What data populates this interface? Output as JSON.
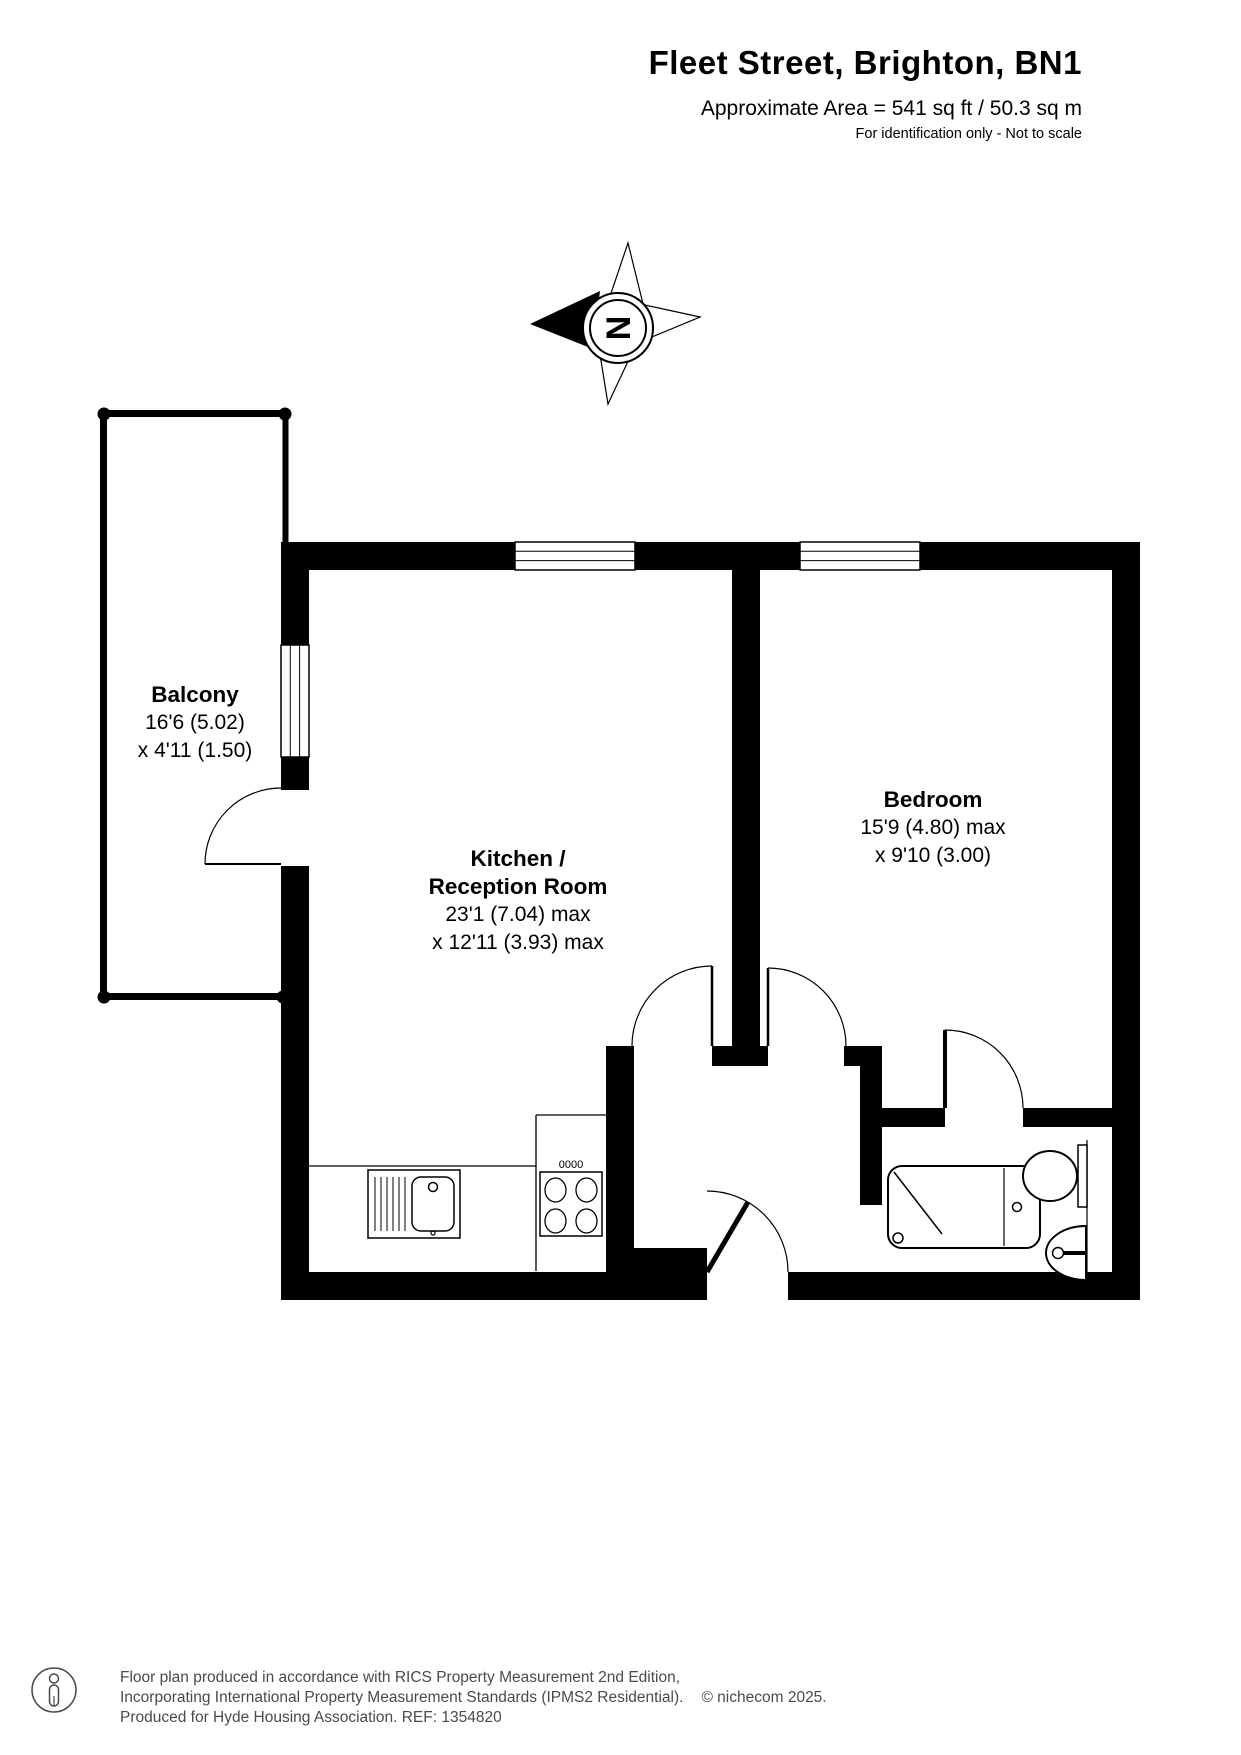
{
  "header": {
    "title": "Fleet Street, Brighton, BN1",
    "area": "Approximate Area = 541 sq ft / 50.3 sq m",
    "disclaimer": "For identification only - Not to scale"
  },
  "compass": {
    "label": "N"
  },
  "rooms": {
    "balcony": {
      "name": "Balcony",
      "dim1": "16'6 (5.02)",
      "dim2": "x 4'11 (1.50)"
    },
    "kitchen": {
      "name1": "Kitchen /",
      "name2": "Reception Room",
      "dim1": "23'1 (7.04) max",
      "dim2": "x 12'11 (3.93) max"
    },
    "bedroom": {
      "name": "Bedroom",
      "dim1": "15'9 (4.80) max",
      "dim2": "x 9'10 (3.00)"
    }
  },
  "fixtures": {
    "hob_knobs": "0000"
  },
  "footer": {
    "line1": "Floor plan produced in accordance with RICS Property Measurement 2nd Edition,",
    "line2": "Incorporating International Property Measurement Standards (IPMS2 Residential).",
    "copyright": "© nichecom 2025.",
    "line3": "Produced for Hyde Housing Association.  REF: 1354820"
  },
  "colors": {
    "wall": "#000000",
    "footer_text": "#4a4a4a"
  }
}
